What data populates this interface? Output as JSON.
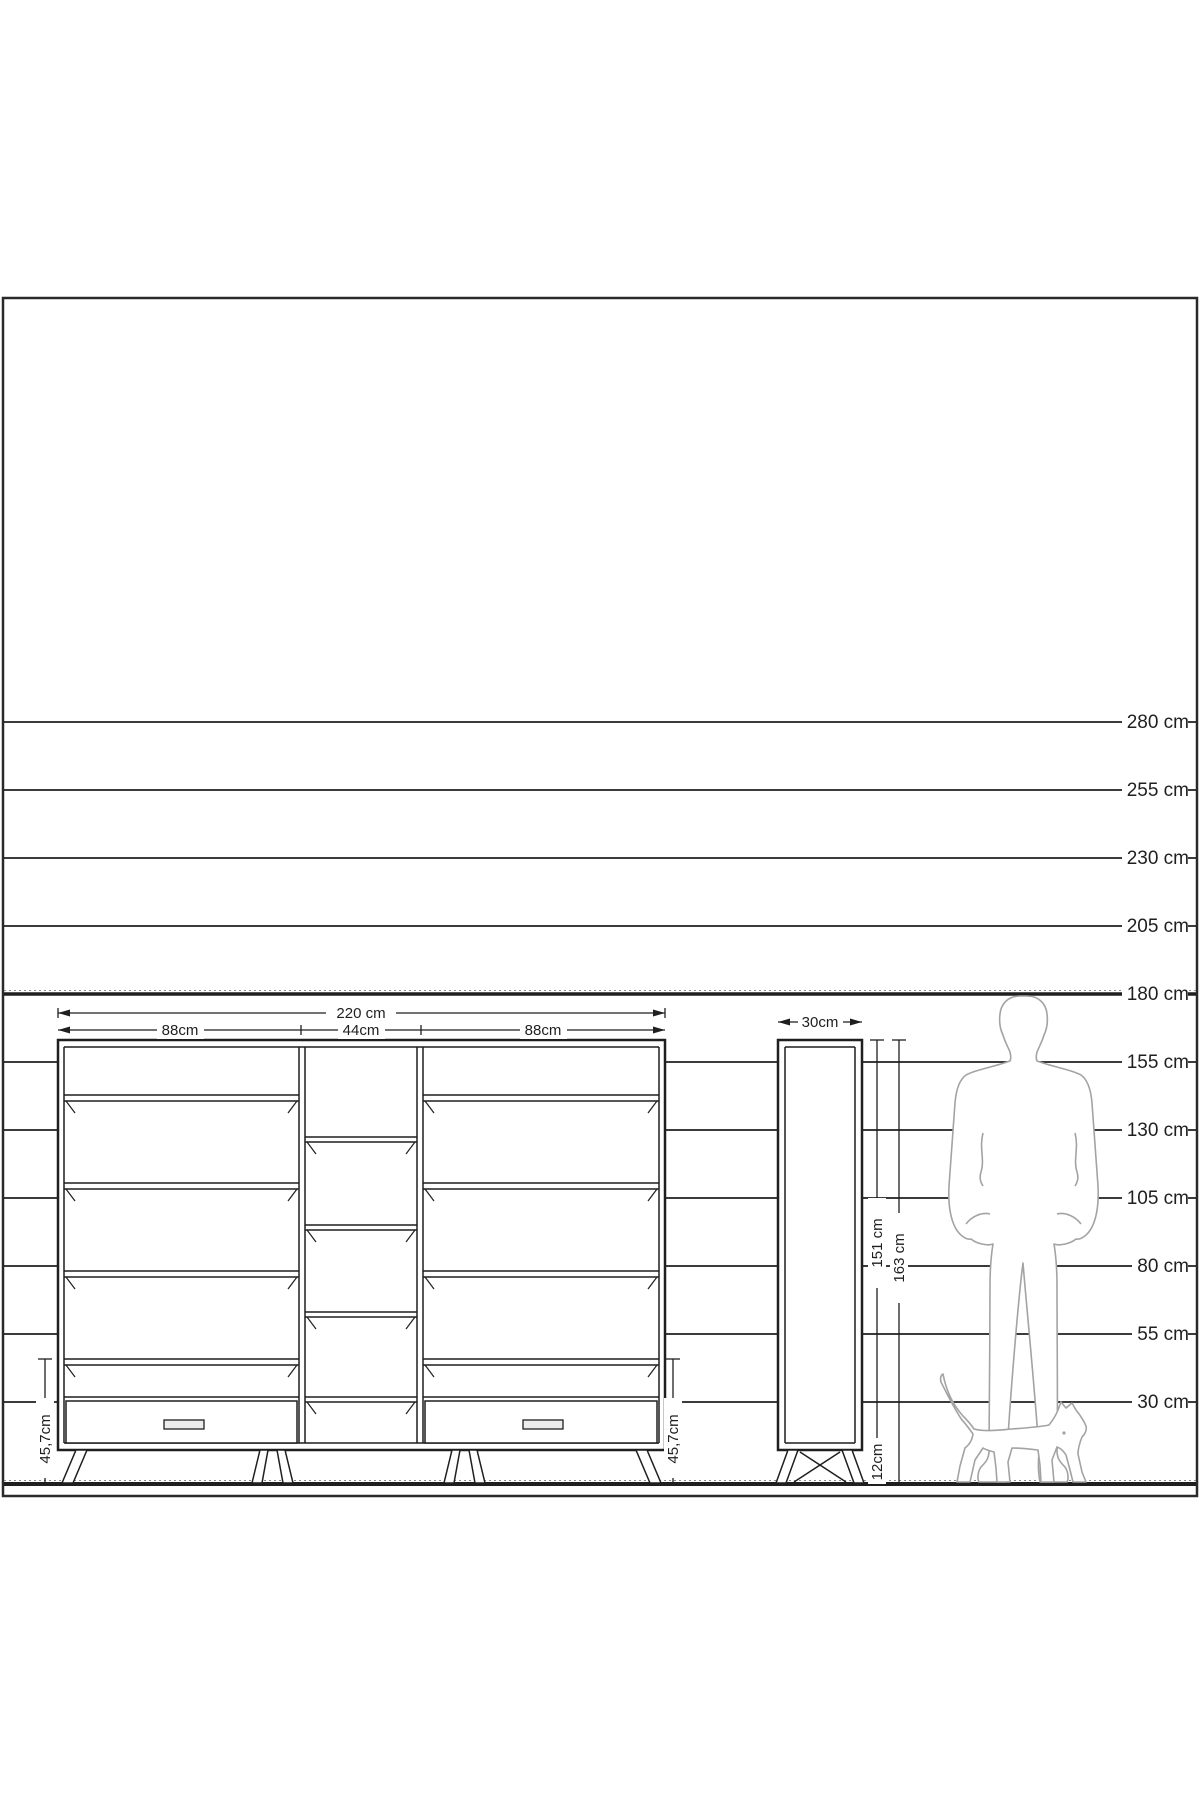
{
  "colors": {
    "ink": "#1f1f1f",
    "silhouette": "#a3a3a3",
    "background": "#ffffff"
  },
  "ruler": {
    "unit": "cm",
    "labels": [
      {
        "label": "280 cm",
        "bold": false
      },
      {
        "label": "255 cm",
        "bold": false
      },
      {
        "label": "230 cm",
        "bold": false
      },
      {
        "label": "205 cm",
        "bold": false
      },
      {
        "label": "180 cm",
        "bold": true
      },
      {
        "label": "155 cm",
        "bold": false
      },
      {
        "label": "130 cm",
        "bold": false
      },
      {
        "label": "105 cm",
        "bold": false
      },
      {
        "label": "80 cm",
        "bold": false
      },
      {
        "label": "55 cm",
        "bold": false
      },
      {
        "label": "30 cm",
        "bold": false
      }
    ]
  },
  "wide_cabinet": {
    "total_width": "220 cm",
    "section_widths": [
      "88cm",
      "44cm",
      "88cm"
    ],
    "base_height_left": "45,7cm",
    "base_height_right": "45,7cm"
  },
  "tall_cabinet": {
    "width": "30cm",
    "body_height": "151 cm",
    "total_height": "163 cm",
    "leg_height": "12cm"
  }
}
